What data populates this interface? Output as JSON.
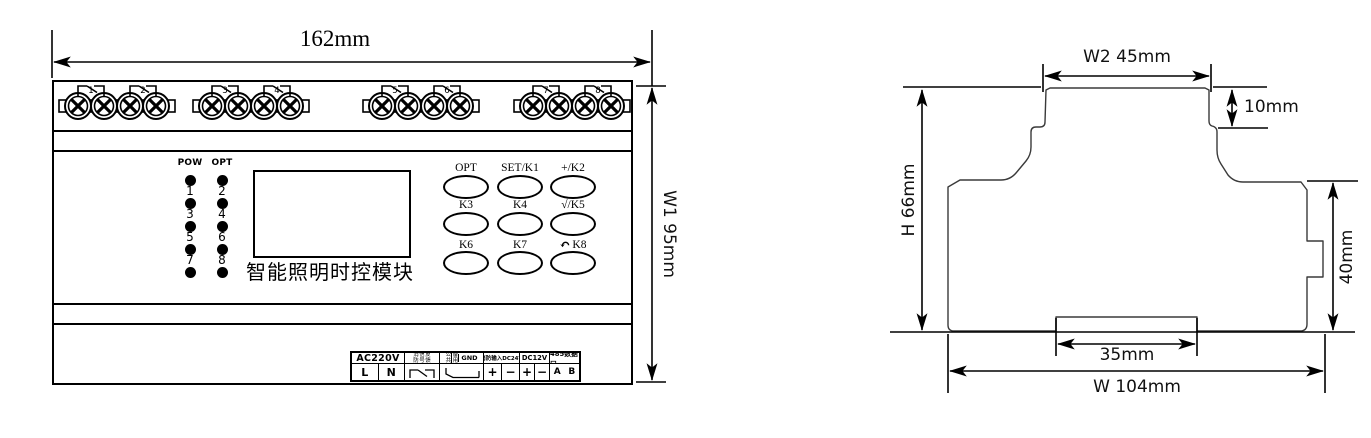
{
  "front_view": {
    "width_dim": "162mm",
    "height_dim": "W1  95mm",
    "relay_numbers": [
      "1",
      "2",
      "3",
      "4",
      "5",
      "6",
      "7",
      "8"
    ],
    "leds": {
      "col1_label": "POW",
      "col2_label": "OPT",
      "col1_numbers": [
        "1",
        "3",
        "5",
        "7"
      ],
      "col2_numbers": [
        "2",
        "4",
        "6",
        "8"
      ]
    },
    "display_title": "智能照明时控模块",
    "buttons": {
      "labels": [
        "OPT",
        "SET/K1",
        "+/K2",
        "K3",
        "K4",
        "√/K5",
        "K6",
        "K7",
        "K8"
      ],
      "k8_icon": "↶"
    },
    "terminal_block": {
      "ac": "AC220V",
      "live": "L",
      "neutral": "N",
      "fire_feedback_col1": "消防",
      "fire_feedback_col2": "信号",
      "fire_feedback_col3": "反馈",
      "common": "公共",
      "spare": "备用",
      "gnd": "GND",
      "fire_input": "消防输入DC24V",
      "dc12v": "DC12V",
      "rs485": "485数据口",
      "plus": "+",
      "minus": "−",
      "a": "A",
      "b": "B"
    }
  },
  "side_view": {
    "w2_dim": "W2  45mm",
    "step_dim": "10mm",
    "h_dim": "H  66mm",
    "clip_dim": "40mm",
    "slot_dim": "35mm",
    "w_dim": "W   104mm"
  }
}
